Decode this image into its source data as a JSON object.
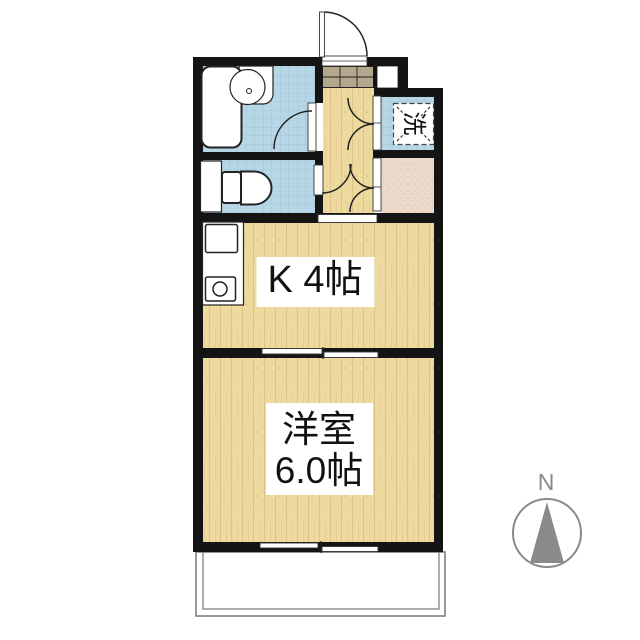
{
  "title": "1K apartment floor plan",
  "labels": {
    "kitchen": "K 4帖",
    "western_room_name": "洋室",
    "western_room_size": "6.0帖",
    "laundry": "洗",
    "compass_north": "N"
  },
  "colors": {
    "wall": "#141414",
    "water_tile": "#b7d7e6",
    "tile_grid": "#9cc2d4",
    "wood": "#eeda9f",
    "wood_grain": "#dcc488",
    "genkan_tile": "#b3a88c",
    "storage_pink": "#ecdacd",
    "storage_speckle": "#dbbfa8",
    "compass_gray": "#8a8a8a",
    "balcony_border": "#777777"
  }
}
